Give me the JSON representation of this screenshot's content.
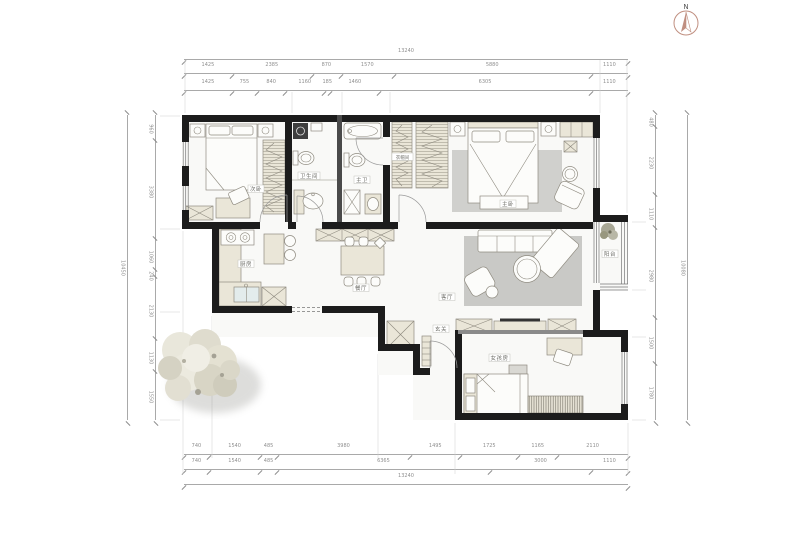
{
  "compass": {
    "label": "N"
  },
  "rooms": {
    "bedroom_small": "次卧",
    "bath": "卫生间",
    "master_bath": "主卫",
    "closet": "衣帽间",
    "master_bedroom": "主卧",
    "kitchen": "厨房",
    "dining": "餐厅",
    "living": "客厅",
    "balcony": "阳台",
    "entry": "玄关",
    "kids_room": "女孩房"
  },
  "dimensions": {
    "top": {
      "outer": [
        13240
      ],
      "middle": [
        1425,
        2385,
        870,
        1570,
        5880,
        1110
      ],
      "inner": [
        1425,
        755,
        840,
        1160,
        185,
        1460,
        6305,
        1110
      ]
    },
    "bottom": {
      "inner": [
        740,
        1540,
        485,
        3980,
        1495,
        1725,
        1165,
        2110
      ],
      "middle": [
        740,
        1540,
        485,
        6365,
        3000,
        1110
      ],
      "outer": [
        13240
      ]
    },
    "left": {
      "outer": [
        10450
      ],
      "inner": [
        960,
        3380,
        1060,
        240,
        2130,
        1130,
        1550
      ]
    },
    "right": {
      "inner": [
        480,
        2230,
        1110,
        2980,
        1500,
        1780
      ],
      "outer": [
        10080
      ]
    }
  },
  "colors": {
    "wall": "#1c1c1c",
    "compass_accent": "#c08f80",
    "furniture_beige": "#eae6d8",
    "rug_gray": "#c9c9c6"
  }
}
